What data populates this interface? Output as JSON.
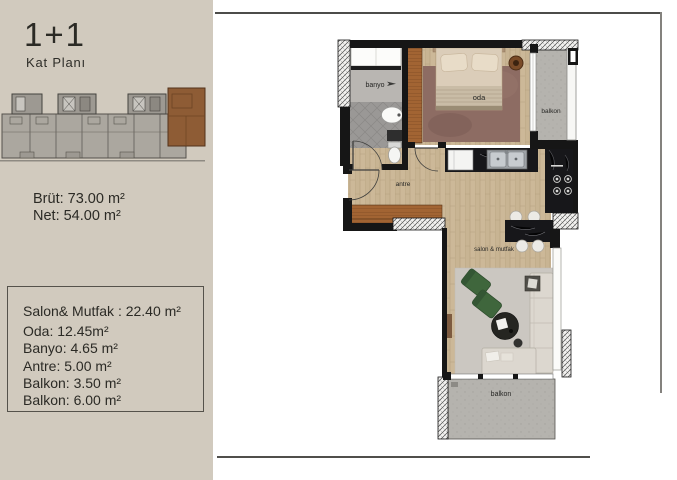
{
  "sidebar": {
    "title": "1+1",
    "subtitle": "Kat Planı",
    "brut": "Brüt: 73.00 m²",
    "net": "Net: 54.00 m²",
    "areas": [
      "Salon& Mutfak : 22.40 m²",
      "Oda: 12.45m²",
      "Banyo: 4.65 m²",
      "Antre: 5.00 m²",
      "Balkon: 3.50 m²",
      "Balkon: 6.00 m²"
    ],
    "background_color": "#d1cabe",
    "highlight_unit_color": "#8e5c35"
  },
  "plan": {
    "room_labels": {
      "banyo": "banyo",
      "oda": "oda",
      "balkon_top": "balkon",
      "antre": "antre",
      "salon_mutfak": "salon & mutfak",
      "balkon_bottom": "balkon"
    },
    "wall_color": "#161616",
    "wood_color": "#c8b493",
    "tile_color": "#9a9896",
    "concrete_color": "#b5b3ae"
  }
}
